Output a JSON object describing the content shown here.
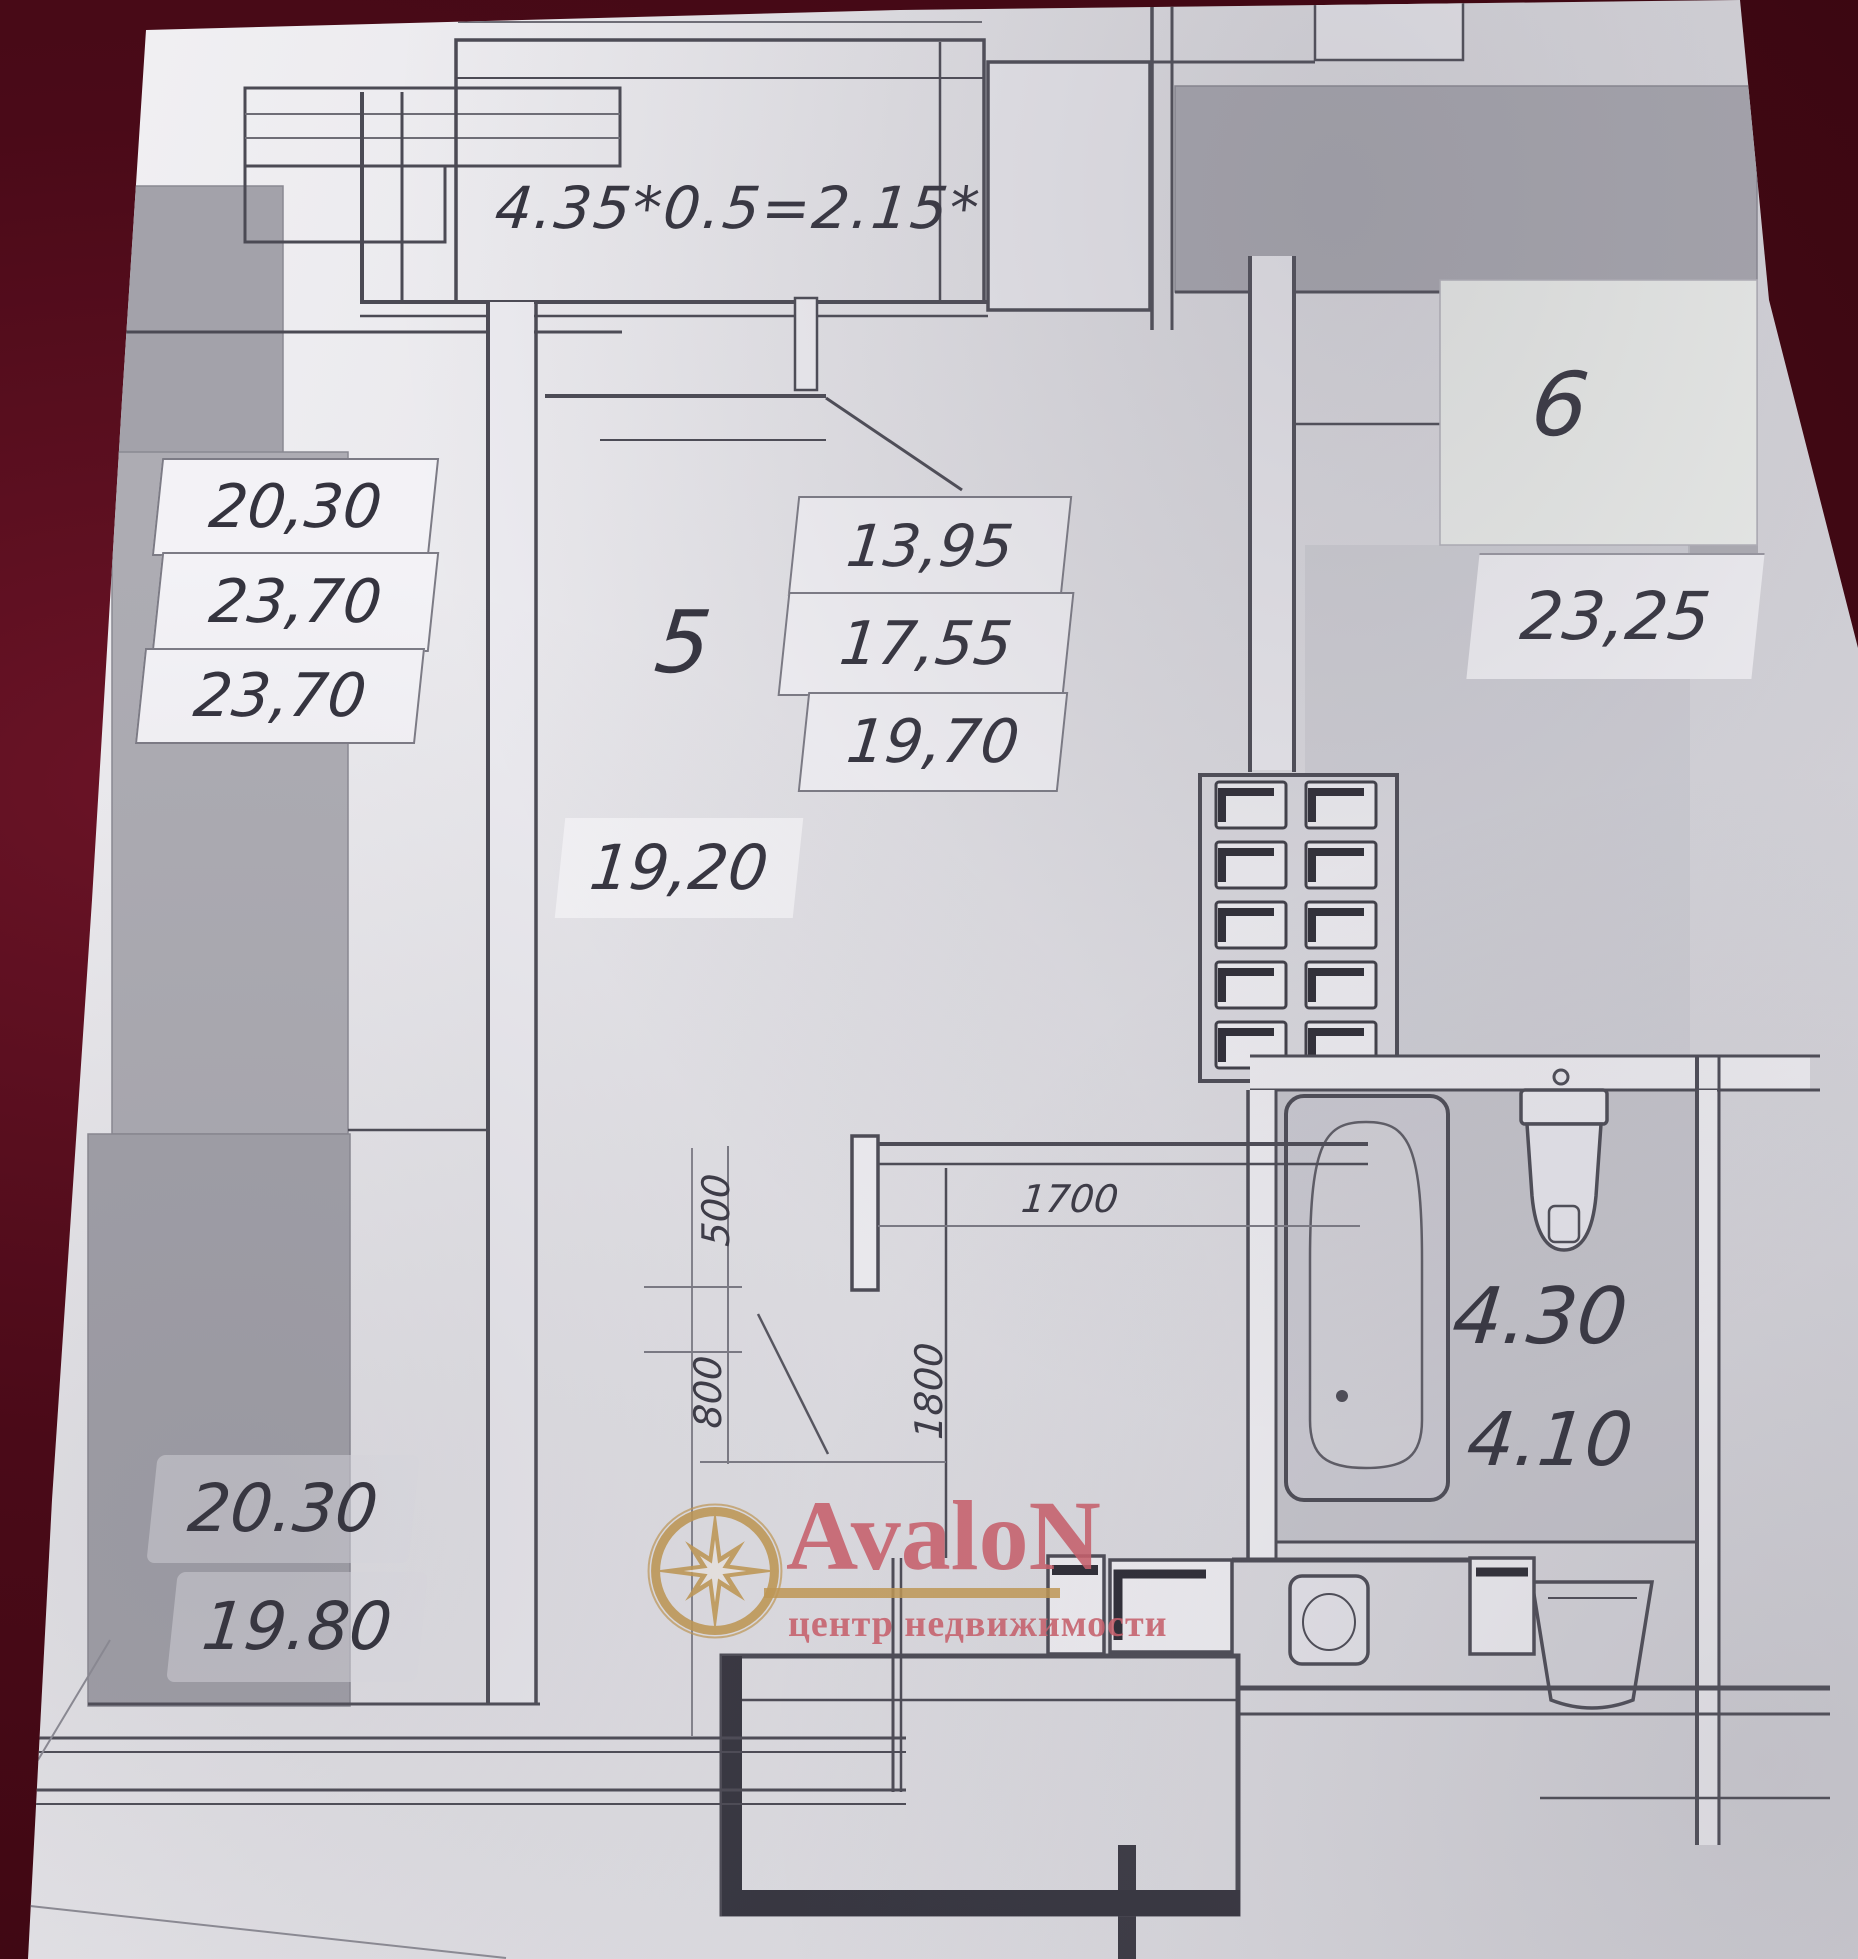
{
  "photo": {
    "background_color": "#4a0a18",
    "paper_color": "#e7e6ea"
  },
  "plan": {
    "balcony_formula": "4.35*0.5=2.15*",
    "left_unit_areas": [
      "20,30",
      "23,70",
      "23,70"
    ],
    "room5": {
      "number": "5",
      "stacked_areas": [
        "13,95",
        "17,55",
        "19,70"
      ],
      "area": "19,20"
    },
    "room6": {
      "number": "6",
      "area": "23,25"
    },
    "bathroom": {
      "area_upper": "4.30",
      "area_lower": "4.10"
    },
    "bottom_left_unit_areas": [
      "20.30",
      "19.80"
    ],
    "dimensions": {
      "d500": "500",
      "d800": "800",
      "d1700": "1700",
      "d1800": "1800"
    }
  },
  "watermark": {
    "brand": "AvaloN",
    "tagline": "центр недвижимости",
    "logo": "compass-star-icon",
    "brand_color": "#cd5f6b",
    "gold_color": "#c49a52"
  }
}
